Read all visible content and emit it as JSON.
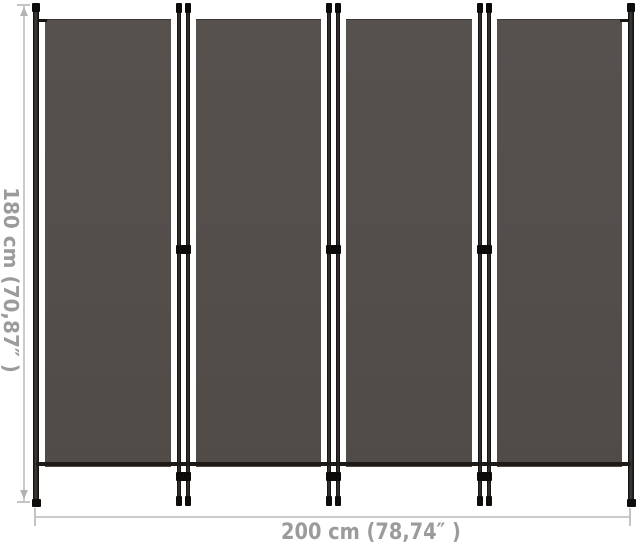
{
  "diagram": {
    "panel_count": 4,
    "height_dimension": {
      "label": "180 cm (70,87″ )"
    },
    "width_dimension": {
      "label": "200 cm (78,74″ )"
    },
    "colors": {
      "fabric": "#544e4b",
      "frame": "#100e0c",
      "dimension_line": "#cbcbcb",
      "dimension_text": "#9b9b9b",
      "background": "#ffffff"
    }
  }
}
